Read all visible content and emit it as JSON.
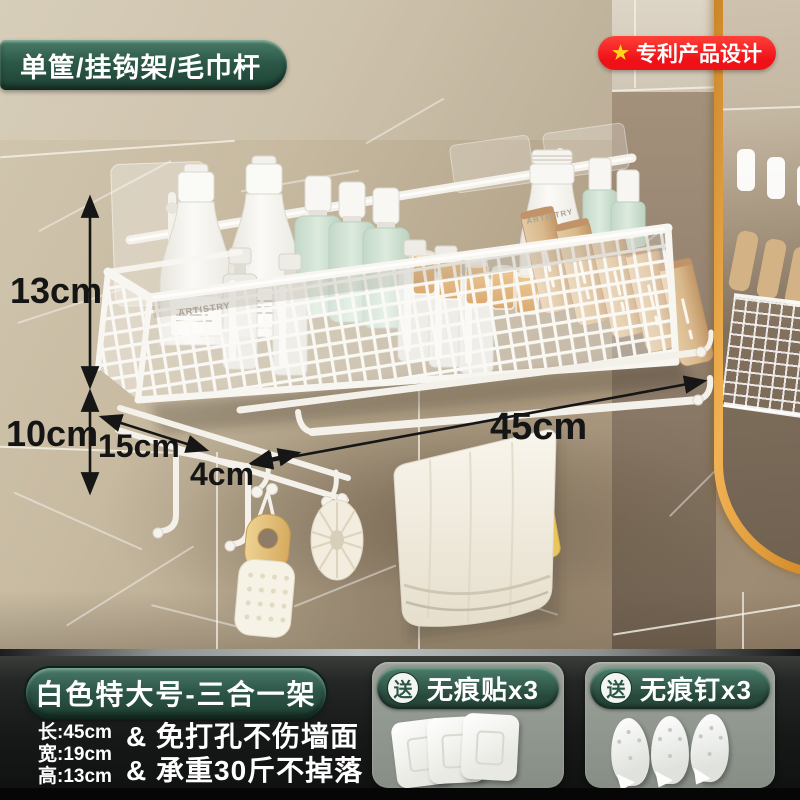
{
  "badges": {
    "top_left": "单筐/挂钩架/毛巾杆",
    "patent": "专利产品设计",
    "patent_star": "★"
  },
  "dimensions": {
    "height": "13cm",
    "hook_drop": "10cm",
    "depth": "15cm",
    "hook_gap": "4cm",
    "width": "45cm"
  },
  "products": {
    "bottle_brand": "ARTISTRY"
  },
  "footer": {
    "title": "白色特大号-三合一架",
    "specs": [
      "长:45cm",
      "宽:19cm",
      "高:13cm"
    ],
    "features": [
      "& 免打孔不伤墙面",
      "& 承重30斤不掉落"
    ],
    "gifts": [
      {
        "tag": "送",
        "label": "无痕贴x3"
      },
      {
        "tag": "送",
        "label": "无痕钉x3"
      }
    ]
  },
  "colors": {
    "badge_green": "#2c5848",
    "badge_red": "#ef1118",
    "star_yellow": "#ffd61a",
    "mirror_gold": "#e2a449",
    "arrow_black": "#161616",
    "wall_beige": "#c6b9a0",
    "basket_white": "#f7f5f0"
  }
}
